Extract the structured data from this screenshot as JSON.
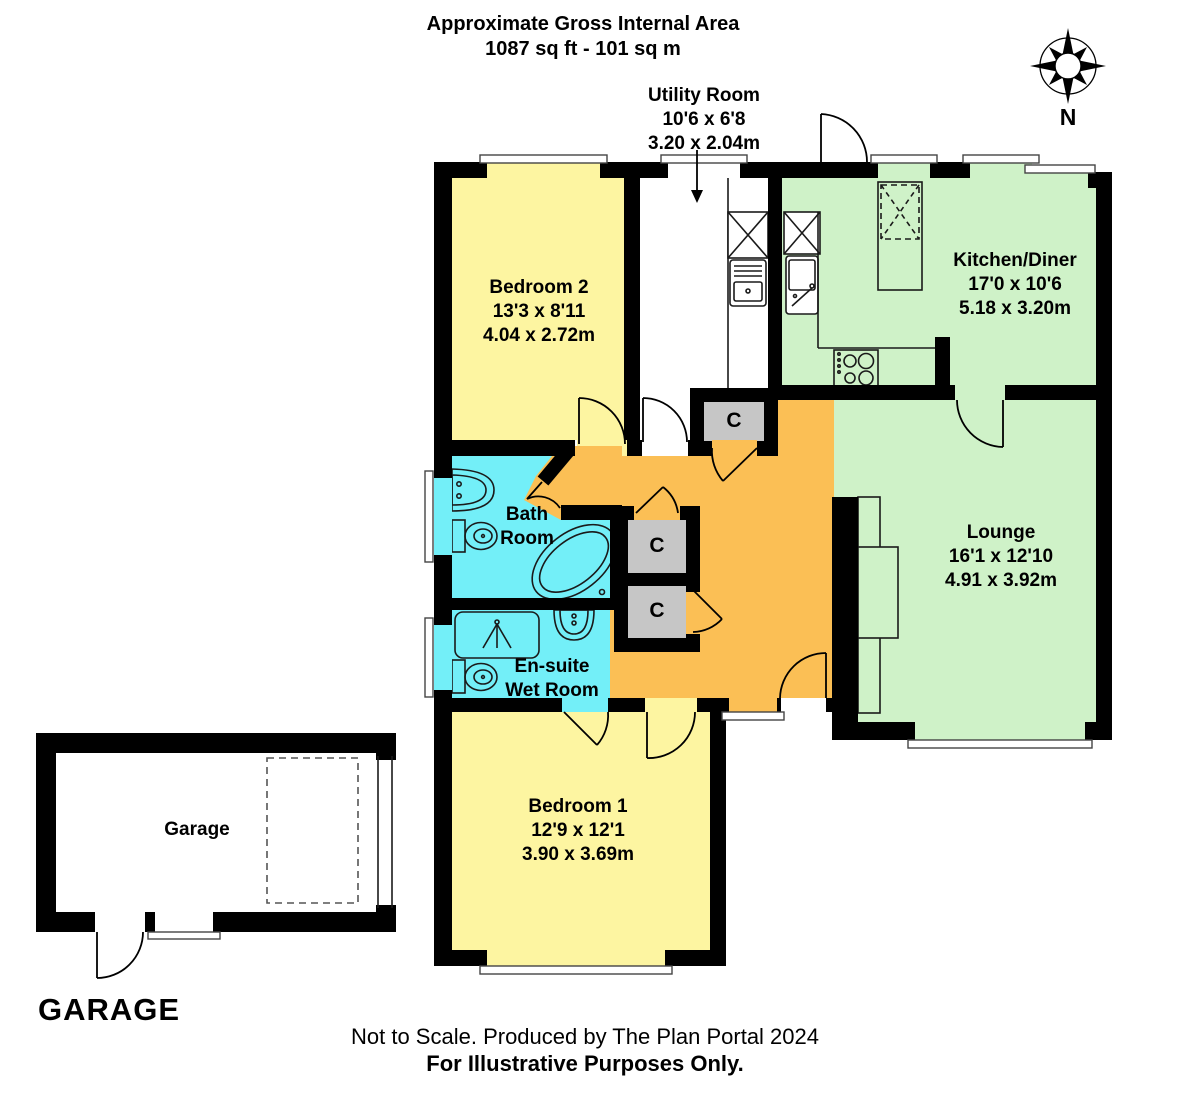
{
  "header": {
    "line1": "Approximate Gross Internal Area",
    "line2": "1087 sq ft - 101 sq m"
  },
  "compass": {
    "label": "N"
  },
  "rooms": {
    "utility": {
      "name": "Utility Room",
      "imperial": "10'6 x 6'8",
      "metric": "3.20 x 2.04m"
    },
    "bedroom2": {
      "name": "Bedroom 2",
      "imperial": "13'3 x 8'11",
      "metric": "4.04 x 2.72m"
    },
    "kitchen": {
      "name": "Kitchen/Diner",
      "imperial": "17'0 x 10'6",
      "metric": "5.18 x 3.20m"
    },
    "lounge": {
      "name": "Lounge",
      "imperial": "16'1 x 12'10",
      "metric": "4.91 x 3.92m"
    },
    "bathroom": {
      "line1": "Bath",
      "line2": "Room"
    },
    "ensuite": {
      "line1": "En-suite",
      "line2": "Wet Room"
    },
    "bedroom1": {
      "name": "Bedroom 1",
      "imperial": "12'9 x 12'1",
      "metric": "3.90 x 3.69m"
    },
    "garage": {
      "name": "Garage"
    }
  },
  "closet_label": "C",
  "garage_heading": "GARAGE",
  "footer": {
    "line1": "Not to Scale. Produced by The Plan Portal 2024",
    "line2": "For Illustrative Purposes Only."
  },
  "colors": {
    "bedroom": "#FDF5A1",
    "living": "#CFF2C8",
    "wet": "#73EFF8",
    "hall": "#FBBF55",
    "closet": "#C6C6C6",
    "wall": "#000000"
  }
}
